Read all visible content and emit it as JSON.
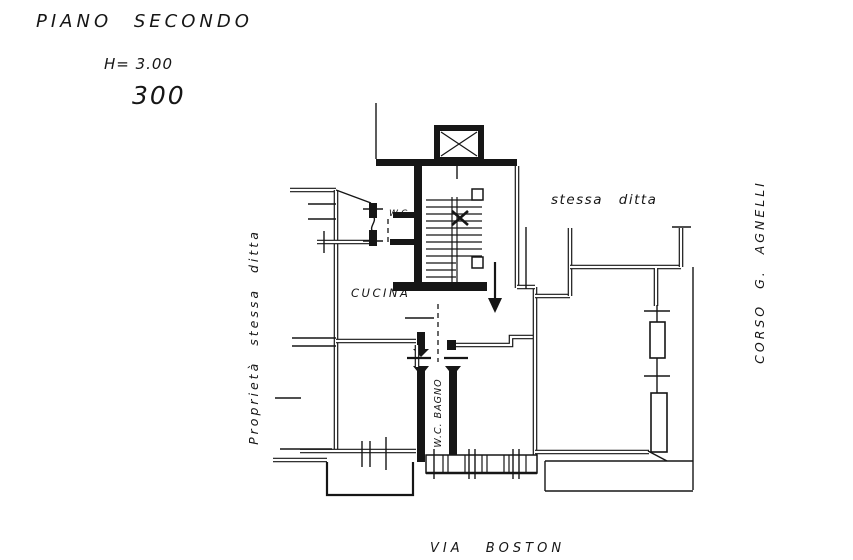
{
  "page_title": {
    "floor": "PIANO SECONDO",
    "height": "H= 3.00",
    "scale": "300"
  },
  "rooms": {
    "kitchen": "CUCINA",
    "wc": "W.C.",
    "wc_bathroom": "W.C. BAGNO"
  },
  "annotations": {
    "adjacent_right": "stessa ditta",
    "adjacent_left": "Proprietà stessa ditta"
  },
  "streets": {
    "south": "VIA BOSTON",
    "east": "CORSO G. AGNELLI"
  },
  "colors": {
    "ink": "#161616",
    "paper": "#ffffff"
  }
}
